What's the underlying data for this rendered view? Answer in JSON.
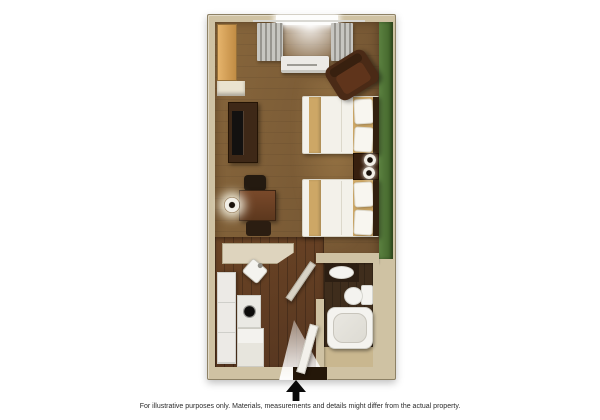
{
  "caption": {
    "text": "For illustrative purposes only.  Materials, measurements and details might differ from the actual property."
  },
  "north_arrow": {
    "direction": "up"
  },
  "floorplan": {
    "type": "hotel-studio-guest-room-top-down-floor-plan",
    "rooms": [
      "main-sleeping-living-area",
      "kitchenette",
      "bathroom"
    ],
    "fixtures": [
      "window",
      "curtains",
      "ac-unit",
      "armchair",
      "closet",
      "tv-dresser",
      "tv",
      "desk",
      "desk-chair",
      "desk-stool",
      "desk-lamp",
      "kitchen-counter",
      "kitchen-sink",
      "refrigerator",
      "stove-burner",
      "kitchen-cabinet",
      "double-bed-1",
      "double-bed-2",
      "nightstand",
      "table-lamp-1",
      "table-lamp-2",
      "bathroom-vanity",
      "vanity-sink",
      "toilet",
      "bathtub",
      "bathroom-door",
      "entry-door"
    ]
  },
  "colors": {
    "page_bg": "#ffffff",
    "wall": "#cfc2a3",
    "wall_outline": "#8d8165",
    "floor": "#6f5130",
    "floor_light": "#87663c",
    "hall_floor": "#563620",
    "hall_floor_light": "#6b4425",
    "accent_wall": "#3f6128",
    "accent_wall_light": "#5b8140",
    "window_white": "#fdfdfc",
    "curtain_light": "#c7c6c1",
    "curtain_dark": "#97958f",
    "appliance_white": "#eceae6",
    "closet_light": "#e5b36b",
    "closet_dark": "#c18c44",
    "dresser": "#3e2817",
    "tv_screen": "#131110",
    "chair_dark": "#241a10",
    "desk_light": "#79492a",
    "desk_dark": "#5d381e",
    "counter": "#ded4be",
    "fixture_white": "#f4f3ef",
    "burner_black": "#0d0c0b",
    "bed_white": "#f3f1ea",
    "bed_runner": "#cda766",
    "pillow_white": "#f8f6f0",
    "headboard": "#32200f",
    "nightstand": "#371f0e",
    "lamp_ring": "#f2efe7",
    "lamp_center": "#1a120b",
    "armchair": "#4a2a16",
    "armchair_inner": "#5f341b",
    "bath_floor": "#3f2d1c",
    "bath_floor_lower": "#c9b78f",
    "vanity_dark": "#2c1e12",
    "door_panel": "#d9d3c6",
    "door_panel_white": "#f3f1eb",
    "threshold_dark": "#241709",
    "arrow_black": "#0a0a0a",
    "caption_text": "#2b2b2b"
  }
}
